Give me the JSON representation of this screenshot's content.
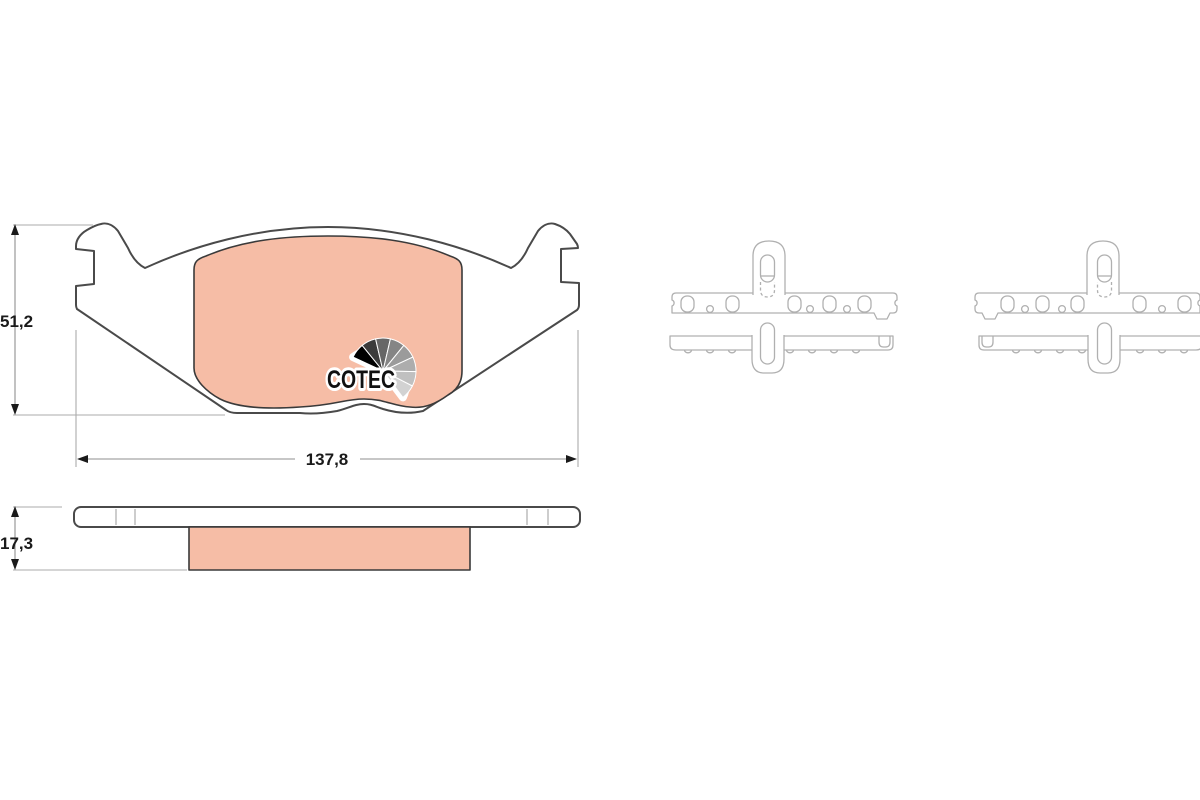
{
  "page": {
    "background_color": "#ffffff",
    "description": "Brake pad set technical drawing with COTEC logo, front view, side profile and two top views with spring clips"
  },
  "colors": {
    "friction_fill": "#f6bda6",
    "plate_outline": "#4a4a4a",
    "clip_outline": "#b0b0b0",
    "dimension_line": "#8f8f8f",
    "label_text": "#1a1a1a"
  },
  "dimensions": {
    "height": {
      "label": "51,2"
    },
    "width": {
      "label": "137,8"
    },
    "thickness": {
      "label": "17,3"
    }
  },
  "logo": {
    "text": "COTEC",
    "fan_colors": [
      "#000000",
      "#3b3b3b",
      "#666666",
      "#858585",
      "#9b9b9b",
      "#adadad",
      "#c0c0c0",
      "#d2d2d2"
    ]
  }
}
